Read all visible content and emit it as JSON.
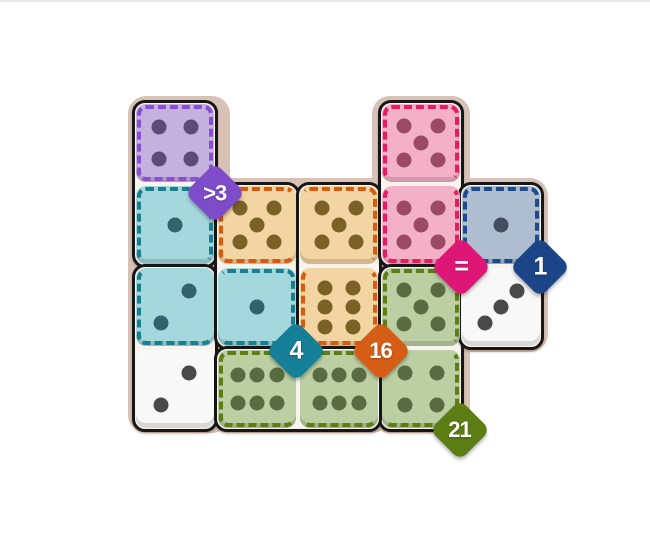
{
  "page": {
    "top_border_color": "#e9e9e9",
    "background": "#ffffff"
  },
  "board": {
    "bg_color": "#d8c2b6",
    "domino_fill": "#f7f3ee",
    "domino_border": "#161616",
    "rects": [
      {
        "x": 128,
        "y": 96,
        "w": 102,
        "h": 337
      },
      {
        "x": 210,
        "y": 178,
        "w": 180,
        "h": 255
      },
      {
        "x": 372,
        "y": 96,
        "w": 98,
        "h": 337
      },
      {
        "x": 452,
        "y": 178,
        "w": 96,
        "h": 174
      }
    ]
  },
  "grid": {
    "cols_x": [
      136,
      218,
      300,
      382,
      462
    ],
    "rows_y": [
      104,
      186,
      268,
      350
    ],
    "cell": 78
  },
  "palette": {
    "purple": {
      "fill": "#c4b1de",
      "pip": "#5d4a79",
      "dash": "#8a4fd0"
    },
    "teal": {
      "fill": "#a5d8dd",
      "pip": "#32626c",
      "dash": "#1a7e8e"
    },
    "tan": {
      "fill": "#f2d5a2",
      "pip": "#7c6127",
      "dash": "#d65c12"
    },
    "pink": {
      "fill": "#f4b0c6",
      "pip": "#9a4a64",
      "dash": "#e71b5e"
    },
    "blue": {
      "fill": "#aebdd0",
      "pip": "#414e5e",
      "dash": "#1c4c8c"
    },
    "green": {
      "fill": "#bccfa3",
      "pip": "#5a6b41",
      "dash": "#5c7e14"
    },
    "white": {
      "fill": "#f8f8f8",
      "pip": "#494949",
      "dash": null
    }
  },
  "pip_layouts": {
    "1": [
      [
        0.5,
        0.5
      ]
    ],
    "2": [
      [
        0.68,
        0.3
      ],
      [
        0.32,
        0.7
      ]
    ],
    "3": [
      [
        0.71,
        0.29
      ],
      [
        0.5,
        0.5
      ],
      [
        0.29,
        0.71
      ]
    ],
    "4": [
      [
        0.3,
        0.3
      ],
      [
        0.7,
        0.3
      ],
      [
        0.3,
        0.7
      ],
      [
        0.7,
        0.7
      ]
    ],
    "5": [
      [
        0.28,
        0.28
      ],
      [
        0.72,
        0.28
      ],
      [
        0.5,
        0.5
      ],
      [
        0.28,
        0.72
      ],
      [
        0.72,
        0.72
      ]
    ],
    "6v": [
      [
        0.32,
        0.25
      ],
      [
        0.68,
        0.25
      ],
      [
        0.32,
        0.5
      ],
      [
        0.68,
        0.5
      ],
      [
        0.32,
        0.75
      ],
      [
        0.68,
        0.75
      ]
    ],
    "6h": [
      [
        0.25,
        0.32
      ],
      [
        0.5,
        0.32
      ],
      [
        0.75,
        0.32
      ],
      [
        0.25,
        0.68
      ],
      [
        0.5,
        0.68
      ],
      [
        0.75,
        0.68
      ]
    ]
  },
  "dominoes": [
    {
      "cells": [
        [
          0,
          0
        ],
        [
          1,
          0
        ]
      ]
    },
    {
      "cells": [
        [
          2,
          0
        ],
        [
          3,
          0
        ]
      ]
    },
    {
      "cells": [
        [
          1,
          1
        ],
        [
          2,
          1
        ]
      ]
    },
    {
      "cells": [
        [
          1,
          2
        ],
        [
          2,
          2
        ]
      ]
    },
    {
      "cells": [
        [
          0,
          3
        ],
        [
          1,
          3
        ]
      ]
    },
    {
      "cells": [
        [
          2,
          3
        ],
        [
          3,
          3
        ]
      ]
    },
    {
      "cells": [
        [
          3,
          1
        ],
        [
          3,
          2
        ]
      ]
    },
    {
      "cells": [
        [
          1,
          4
        ],
        [
          2,
          4
        ]
      ]
    }
  ],
  "dice": [
    {
      "row": 0,
      "col": 0,
      "pips": "4",
      "color": "purple",
      "dash": [
        "t",
        "l",
        "r",
        "b"
      ]
    },
    {
      "row": 1,
      "col": 0,
      "pips": "1",
      "color": "teal",
      "dash": [
        "t",
        "l",
        "r"
      ]
    },
    {
      "row": 2,
      "col": 0,
      "pips": "2",
      "color": "teal",
      "dash": [
        "l",
        "b"
      ]
    },
    {
      "row": 3,
      "col": 0,
      "pips": "2",
      "color": "white",
      "dash": []
    },
    {
      "row": 1,
      "col": 1,
      "pips": "5",
      "color": "tan",
      "dash": [
        "t",
        "l",
        "b"
      ]
    },
    {
      "row": 2,
      "col": 1,
      "pips": "1",
      "color": "teal",
      "dash": [
        "t",
        "r",
        "b"
      ]
    },
    {
      "row": 3,
      "col": 1,
      "pips": "6h",
      "color": "green",
      "dash": [
        "t",
        "l",
        "b"
      ]
    },
    {
      "row": 1,
      "col": 2,
      "pips": "5",
      "color": "tan",
      "dash": [
        "t",
        "r"
      ]
    },
    {
      "row": 2,
      "col": 2,
      "pips": "6v",
      "color": "tan",
      "dash": [
        "l",
        "r",
        "b"
      ]
    },
    {
      "row": 3,
      "col": 2,
      "pips": "6h",
      "color": "green",
      "dash": [
        "t",
        "b"
      ]
    },
    {
      "row": 0,
      "col": 3,
      "pips": "5",
      "color": "pink",
      "dash": [
        "t",
        "l",
        "r"
      ]
    },
    {
      "row": 1,
      "col": 3,
      "pips": "5",
      "color": "pink",
      "dash": [
        "l",
        "r",
        "b"
      ]
    },
    {
      "row": 2,
      "col": 3,
      "pips": "5",
      "color": "green",
      "dash": [
        "t",
        "l",
        "r"
      ]
    },
    {
      "row": 3,
      "col": 3,
      "pips": "4",
      "color": "green",
      "dash": [
        "r",
        "b"
      ]
    },
    {
      "row": 1,
      "col": 4,
      "pips": "1",
      "color": "blue",
      "dash": [
        "t",
        "l",
        "r",
        "b"
      ]
    },
    {
      "row": 2,
      "col": 4,
      "pips": "3",
      "color": "white",
      "dash": []
    }
  ],
  "badges": [
    {
      "name": "constraint-greater-than-3",
      "label": ">3",
      "color": "#7e4cc9",
      "x": 215,
      "y": 193
    },
    {
      "name": "constraint-equal",
      "label": "=",
      "color": "#de1777",
      "x": 461,
      "y": 267
    },
    {
      "name": "constraint-sum-1",
      "label": "1",
      "color": "#1b4586",
      "x": 540,
      "y": 267
    },
    {
      "name": "constraint-sum-4",
      "label": "4",
      "color": "#147f96",
      "x": 296,
      "y": 351
    },
    {
      "name": "constraint-sum-16",
      "label": "16",
      "color": "#d65d15",
      "x": 381,
      "y": 351
    },
    {
      "name": "constraint-sum-21",
      "label": "21",
      "color": "#5b7d13",
      "x": 460,
      "y": 430
    }
  ]
}
